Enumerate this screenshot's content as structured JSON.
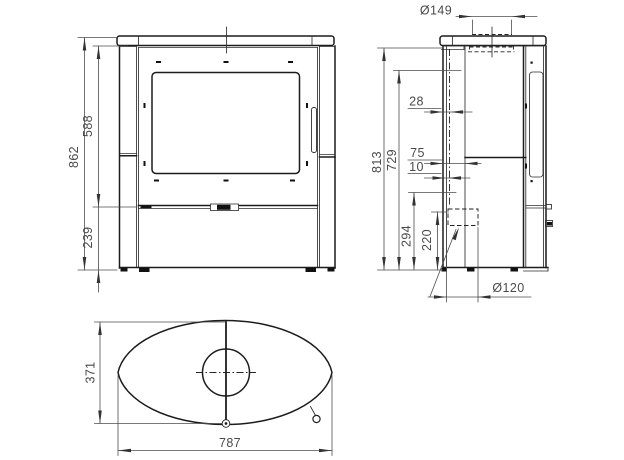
{
  "drawing": {
    "front_view": {
      "height_total": "862",
      "height_upper": "588",
      "height_base": "239"
    },
    "side_view": {
      "flue_top_diameter": "Ø149",
      "height_back": "813",
      "height_mid": "729",
      "offset_flue_center": "28",
      "offset_75": "75",
      "offset_10": "10",
      "height_294": "294",
      "height_220": "220",
      "flue_rear_diameter": "Ø120"
    },
    "top_view": {
      "depth": "371",
      "width": "787"
    }
  }
}
